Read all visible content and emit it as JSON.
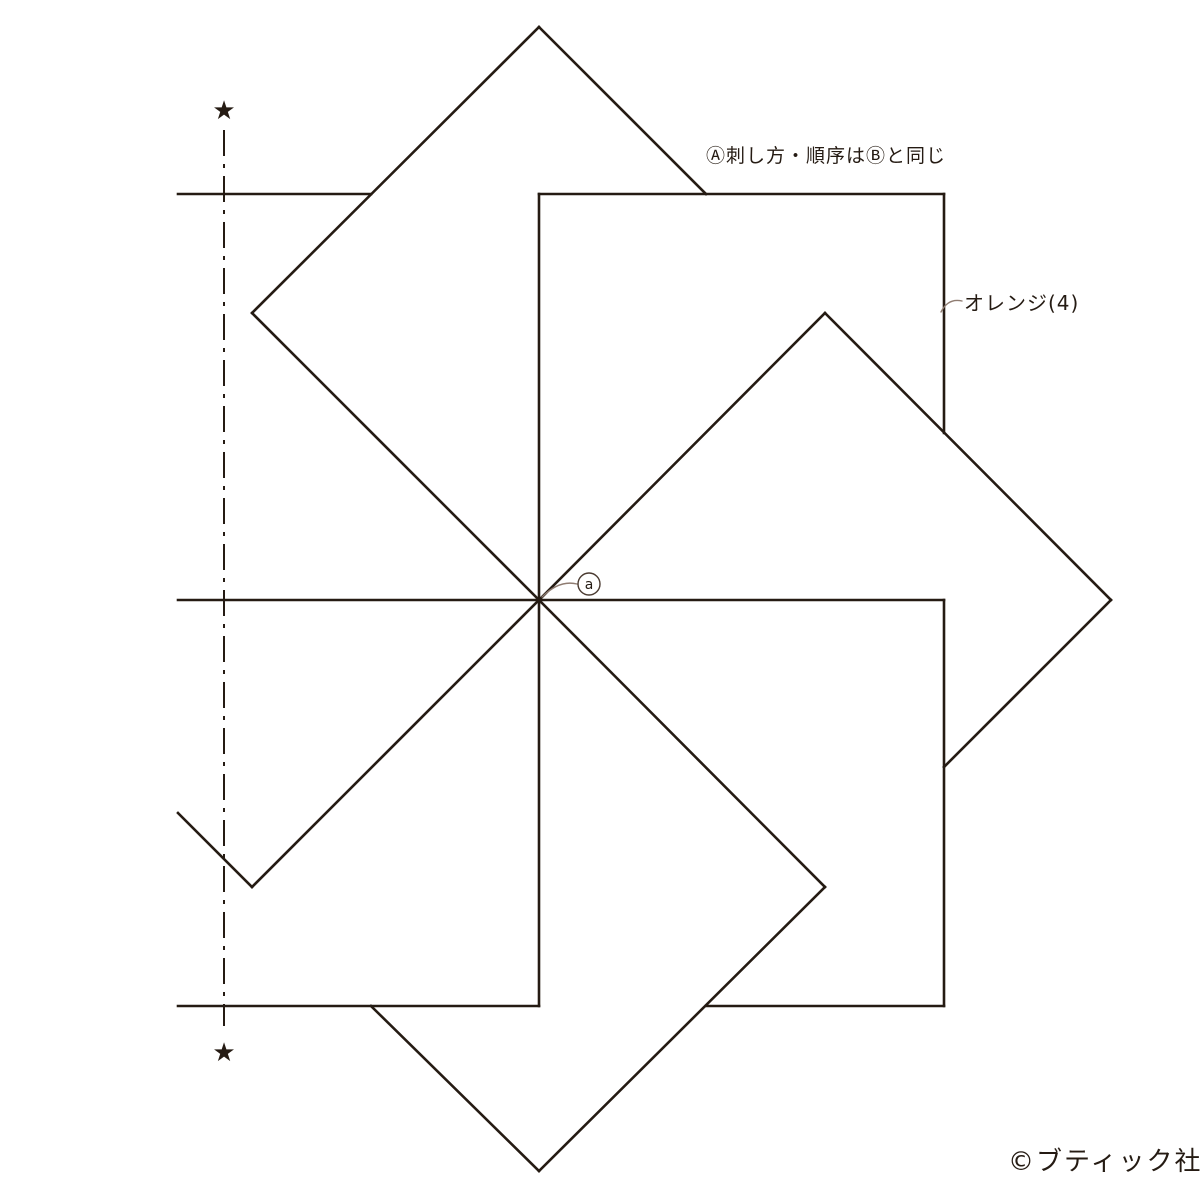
{
  "canvas": {
    "width": 1200,
    "height": 1200,
    "background": "#ffffff"
  },
  "colors": {
    "line": "#251b13",
    "leader": "#8f7c71",
    "marker_stroke": "#4a3a30",
    "text": "#251b13"
  },
  "labels": {
    "stitch_note": "Ⓐ刺し方・順序はⒷと同じ",
    "color_callout": "オレンジ(4)",
    "copyright": "©ブティック社",
    "center_marker": "a",
    "star_glyph": "★"
  },
  "diagram": {
    "description": "pinwheel of 8 overlapping squares sharing center point",
    "center": [
      539,
      600
    ],
    "stroke_width": 2.6,
    "segments": [
      [
        539,
        600,
        539,
        194
      ],
      [
        539,
        600,
        825,
        313
      ],
      [
        539,
        600,
        252,
        313
      ],
      [
        539,
        600,
        178,
        600
      ],
      [
        539,
        600,
        252,
        887
      ],
      [
        539,
        600,
        539,
        1006
      ],
      [
        539,
        600,
        825,
        887
      ],
      [
        539,
        600,
        944,
        600
      ],
      [
        539,
        194,
        944,
        194
      ],
      [
        944,
        194,
        944,
        433
      ],
      [
        252,
        313,
        539,
        27
      ],
      [
        539,
        27,
        706,
        194
      ],
      [
        178,
        194,
        371,
        194
      ],
      [
        178,
        813,
        252,
        887
      ],
      [
        178,
        1006,
        539,
        1006
      ],
      [
        371,
        1006,
        539,
        1171
      ],
      [
        539,
        1171,
        825,
        887
      ],
      [
        944,
        600,
        944,
        1006
      ],
      [
        706,
        1006,
        944,
        1006
      ],
      [
        825,
        313,
        1111,
        600
      ],
      [
        1111,
        600,
        944,
        767
      ]
    ],
    "chain_line": {
      "x": 224,
      "y1": 130,
      "y2": 1026,
      "dash": "26 8 4 8",
      "width": 2
    },
    "stars": [
      {
        "x": 224,
        "y": 110
      },
      {
        "x": 224,
        "y": 1052
      }
    ],
    "leaders": [
      {
        "d": "M 542,597 C 553,586 565,581 577,584"
      },
      {
        "d": "M 941,312 C 946,302 953,299 962,301"
      }
    ],
    "marker": {
      "cx": 589,
      "cy": 584,
      "r": 11,
      "font_size": 14
    },
    "star_font_size": 26
  }
}
